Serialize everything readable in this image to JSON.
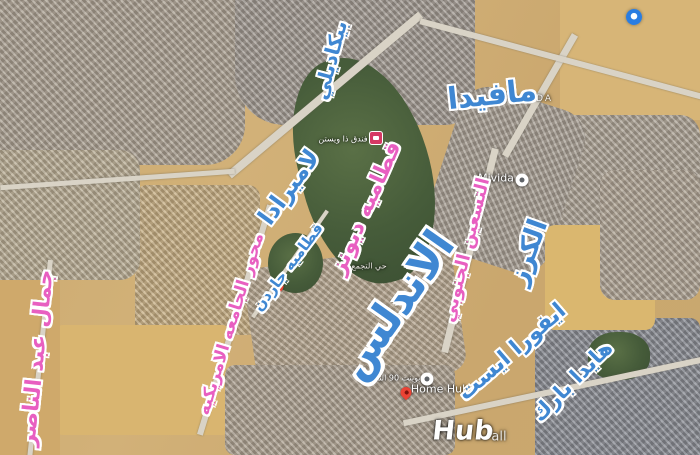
{
  "app": {
    "type": "satellite-map-screenshot",
    "area": "New Cairo"
  },
  "colors": {
    "label_blue": "#3f87d2",
    "label_pink": "#e85fc1",
    "label_outline": "#ffffff",
    "pin_red": "#ea4335",
    "pin_hotel": "#d63864",
    "pin_white": "#ffffff",
    "watermark_blue": "#2a7de1",
    "desert": "#cbaa70",
    "golf_green": "#465c3a"
  },
  "labels": {
    "piccadilly": "بيكاديلي",
    "mafida": "مافيدا",
    "lamirada": "لاميرادا",
    "katameya_dunes": "قطاميه ديونز",
    "katameya_garden": "قطاميه جاردن",
    "auc_axis": "محور الجامعه الامريكيه",
    "south90": "التسعين الجنوبي",
    "andalus": "الاندلس",
    "cherry": "الكرز",
    "evora_east": "ايفورا ايست",
    "hyde_park": "هايدا بارك",
    "nasser": "جمال عبد الناصر"
  },
  "small_labels": {
    "mivida_caps": "MIVIDA",
    "mivida": "Mivida",
    "westin_hotel": "فندق ذا ويستن",
    "hay_tagamoa": "حي التجمع",
    "point90": "بوينت 90 التجاري",
    "home_hub": "Home Hub",
    "hub": "Hub",
    "hub_suffix": "all"
  },
  "icons": {
    "hotel_pin": "hotel-marker-icon",
    "red_pin": "map-pin-icon",
    "white_pin": "poi-circle-icon",
    "watermark": "blue-circle-watermark-icon"
  }
}
